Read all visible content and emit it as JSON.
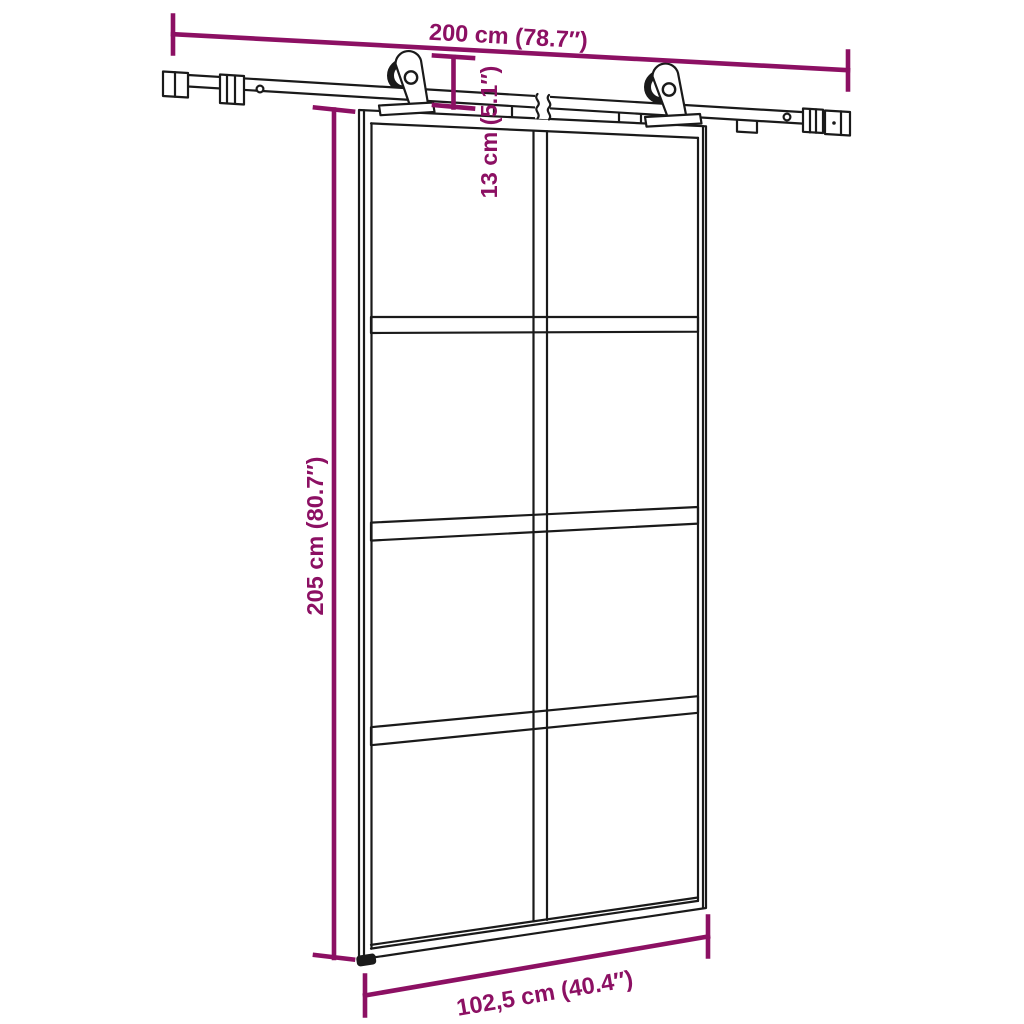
{
  "page": {
    "background": "#ffffff"
  },
  "colors": {
    "dimension_annotation": "#8C1063",
    "artwork_line": "#1A1A1A"
  },
  "door_grid": {
    "columns": 2,
    "rows": 4,
    "glass_panes": 8
  },
  "dimensions": {
    "rail_length": "200 cm (78.7″)",
    "rail_to_door_offset": "13 cm (5.1″)",
    "door_height": "205 cm (80.7″)",
    "door_width": "102,5 cm (40.4″)"
  }
}
